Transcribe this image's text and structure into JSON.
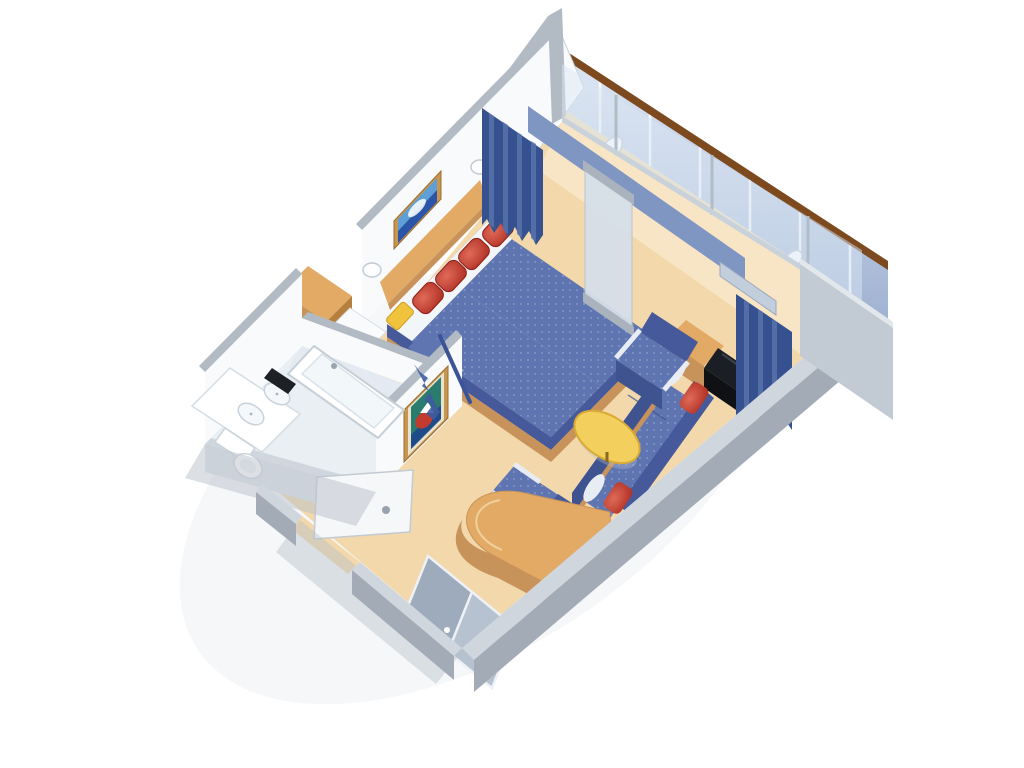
{
  "scene": {
    "setting": "3D isometric cutaway rendering of a cruise-ship stateroom with private balcony",
    "rooms": [
      "bedroom-living-area",
      "bathroom",
      "entry-hall",
      "balcony"
    ],
    "objects": [
      "twin-bed",
      "headboard",
      "seascape-artwork",
      "wall-sconce",
      "red-accent-pillow",
      "yellow-accent-pillow",
      "nightstand",
      "vanity-cabinet",
      "vanity-stool",
      "bathtub",
      "twin-sink-vanity",
      "amenity-tray",
      "toilet",
      "sofa",
      "armchair",
      "coffee-table",
      "television",
      "tv-cabinet",
      "writing-desk",
      "sliding-glass-door",
      "privacy-panel",
      "drapery",
      "balcony-railing",
      "balcony-chair",
      "entry-door",
      "wardrobe-sliding-doors",
      "boat-artwork"
    ],
    "counts": {
      "twin_beds": 2,
      "red_pillows": 4,
      "yellow_pillows": 2,
      "armchairs": 2,
      "artworks": 2,
      "sinks": 2,
      "balcony_chairs": 2,
      "curtains": 2
    }
  },
  "palette": {
    "background": "#ffffff",
    "floor": "#f2d8ab",
    "floor_light": "#f9ecd2",
    "bathroom_floor": "#eaeff4",
    "balcony_floor": "#f0dcb6",
    "wall_white": "#f8fafc",
    "wall_cap": "#b2bac4",
    "cut_wall_top": "#cfd6de",
    "cut_wall_face": "#a2abb6",
    "glass": "#d9e6f3",
    "frame_gray": "#b2bcc7",
    "track_blue": "#8096c2",
    "rail_wood": "#7c4a1e",
    "rail_face": "#c3d0e4",
    "rail_rib": "#ffffff",
    "curtain_dark": "#35518f",
    "curtain_mid": "#5b74ad",
    "valance": "#c3cedd",
    "bed_blue": "#5f75b2",
    "bed_blue_dark": "#46599b",
    "sheet_white": "#f3f6f9",
    "wood": "#e2aa64",
    "wood_dark": "#c8935a",
    "wood_deep": "#b77f3e",
    "pillow_red": "#c6402f",
    "pillow_red_dark": "#8e1f16",
    "pillow_yellow": "#f1c33c",
    "sofa_back": "#46599b",
    "sofa_seat": "#5f75b2",
    "sofa_face": "#3e5390",
    "armrest": "#e8edf3",
    "table_yellow": "#f3cf5e",
    "table_edge": "#d9ab32",
    "tv_black": "#1b1e24",
    "fixture_white": "#ffffff",
    "fixture_shadow": "#d9e1e8",
    "tray_black": "#1d2126",
    "art_frame": "#c8964e",
    "art_sky": "#5e9fd8",
    "art_sea": "#2a55a8",
    "art_teal": "#2a7d6e",
    "art_red": "#c23b2e",
    "art_navy": "#1d3f8f",
    "shadow": "#b9c0ca"
  }
}
